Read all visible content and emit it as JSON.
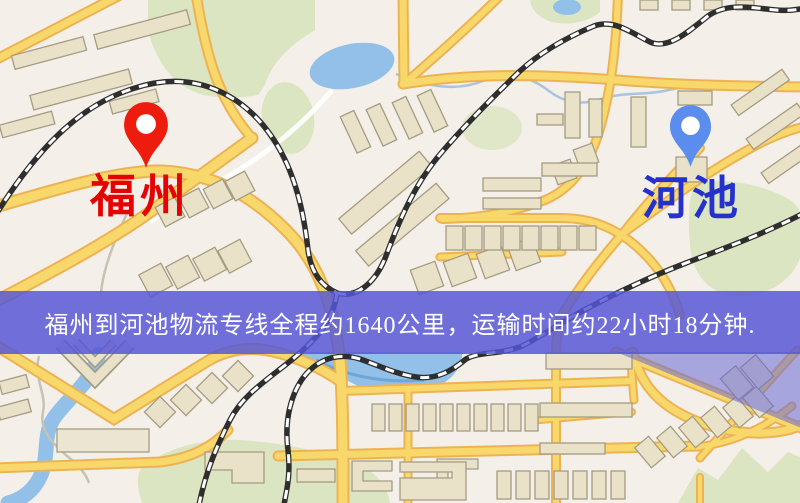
{
  "banner": {
    "text": "福州到河池物流专线全程约1640公里，运输时间约22小时18分钟.",
    "background_color": "#5656d6",
    "text_color": "#ffffff"
  },
  "markers": {
    "origin": {
      "label": "福州",
      "label_color": "#e60202",
      "pin_color": "#ee1c0e",
      "icon": "location-pin-icon"
    },
    "destination": {
      "label": "河池",
      "label_color": "#2531cd",
      "pin_color": "#5a8ded",
      "icon": "location-pin-icon"
    }
  },
  "map": {
    "colors": {
      "background": "#f4efe8",
      "road_fill": "#f9d86b",
      "road_casing": "#edb353",
      "building_fill": "#e9e1c8",
      "building_outline": "#a59c82",
      "green_area": "#dbe5c1",
      "water": "#92c0e8",
      "railway": "#2e2e2e",
      "highlight_overlay": "#6c6cd6"
    }
  }
}
